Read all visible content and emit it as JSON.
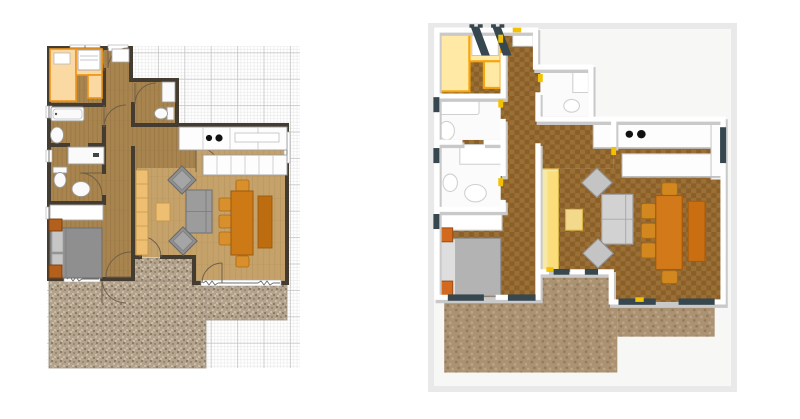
{
  "app": {
    "name": "floor-plan-editor"
  },
  "panels": {
    "plan2d": {
      "name": "2D floor plan view"
    },
    "view3d": {
      "name": "3D aerial view"
    }
  },
  "colors": {
    "page-bg": "#ffffff",
    "grid-minor": "#e8e8e8",
    "grid-major": "#c2c2c2",
    "wall2d": "#453c31",
    "floor-dark": "#a8854f",
    "floor-dark-line": "#8f6d3c",
    "floor-light": "#c6a26b",
    "floor-light-line": "#ab8751",
    "counter-fill": "#fbd9a2",
    "counter-edge": "#f09518",
    "fixture-fill": "#fafafa",
    "fixture-edge": "#9a9a9a",
    "bed": "#8f8f8f",
    "bed-edge": "#6d6d6d",
    "pillow": "#c6c6c6",
    "nightstand": "#b3601c",
    "nightstand-edge": "#7d3f0e",
    "sofa2d": "#9c9c9c",
    "sofa2d-edge": "#707070",
    "table-tan": "#eebf72",
    "table-tan-edge": "#c3964a",
    "dining": "#cd7a16",
    "dining-edge": "#9a5a0e",
    "chair": "#d9902c",
    "sideboard": "#bd6c10",
    "terrace-base": "#b3a28c",
    "terrace-dark": "#998871",
    "terrace-dark2": "#8d7c65",
    "terrace-light": "#c9bca8",
    "door-arc": "#6f6049",
    "canvas3d": "#e9e9e9",
    "ground3d": "#f7f7f6",
    "wall3d": "#ffffff",
    "wall3d-shadow": "#c9c9c9",
    "checker-a": "#8a6028",
    "checker-b": "#9b7037",
    "terrace3d": "#ab9272",
    "terrace3d-dark": "#93795b",
    "terrace3d-light": "#bda687",
    "winbar": "#37474f",
    "door-tick": "#f2c200",
    "white3d": "#fbfbfb",
    "gray3d-edge": "#c4c4c4",
    "counter3d-fill": "#ffe9a4",
    "counter3d-edge": "#f5a40a",
    "shelf3d": "#f6e8a6",
    "shelf3d-edge": "#d8b64e",
    "sofa3d": "#d2d2d2",
    "sofa3d-edge": "#9f9f9f",
    "bed3d": "#b3b3b3"
  }
}
